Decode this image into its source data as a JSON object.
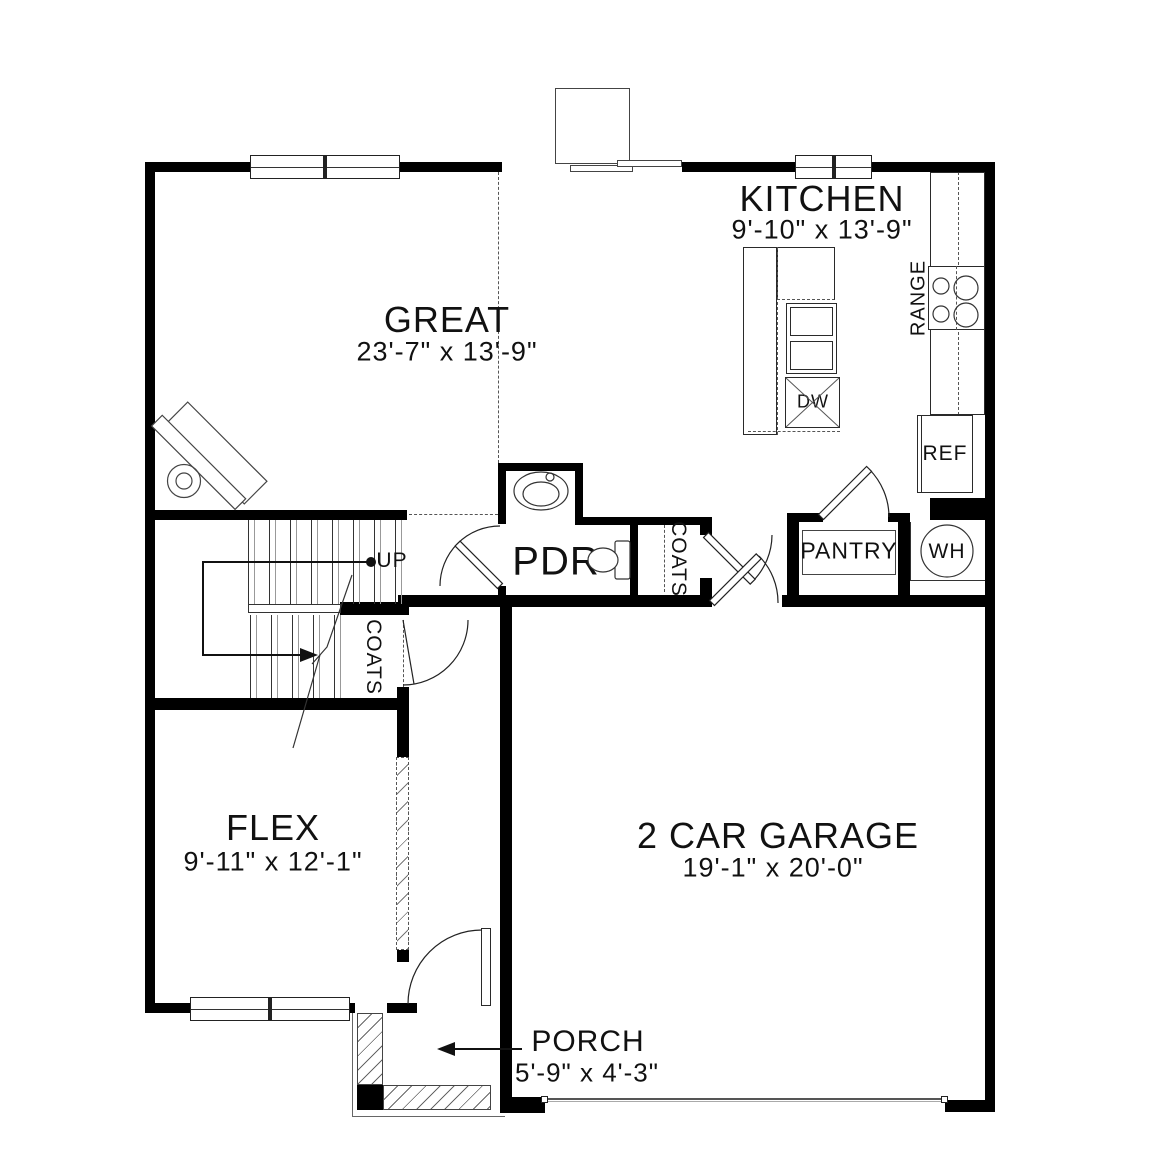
{
  "plan": {
    "rooms": {
      "great": {
        "name": "GREAT",
        "dims": "23'-7\" x 13'-9\""
      },
      "kitchen": {
        "name": "KITCHEN",
        "dims": "9'-10\" x 13'-9\""
      },
      "flex": {
        "name": "FLEX",
        "dims": "9'-11\" x 12'-1\""
      },
      "garage": {
        "name": "2 CAR GARAGE",
        "dims": "19'-1\" x 20'-0\""
      },
      "porch": {
        "name": "PORCH",
        "dims": "5'-9\" x 4'-3\""
      },
      "powder": {
        "name": "PDR"
      }
    },
    "closets": {
      "pantry": "PANTRY",
      "coats_hall": "COATS",
      "coats_stairs": "COATS"
    },
    "appliances": {
      "range": "RANGE",
      "refrigerator": "REF",
      "dishwasher": "DW",
      "water_heater": "WH"
    },
    "stairs": {
      "direction_label": "UP"
    },
    "colors": {
      "wall": "#000000",
      "line": "#222222",
      "garage_door": "#888888",
      "background": "#ffffff"
    }
  }
}
